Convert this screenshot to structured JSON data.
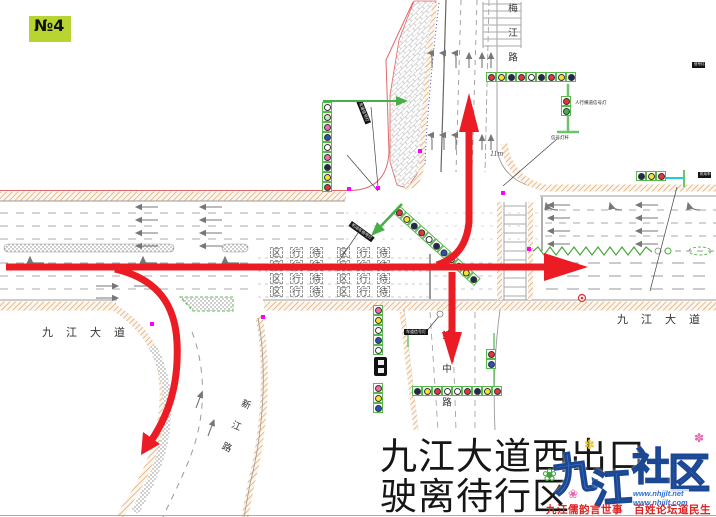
{
  "badge": {
    "label": "№4",
    "bg": "#b7d433"
  },
  "title": {
    "line1": "九江大道西出口",
    "line2": "驶离待行区"
  },
  "road_labels": {
    "west": "九江大道",
    "east": "九江大道",
    "north": "梅江路",
    "south": "建中路",
    "southwest": "新江路"
  },
  "lane_marking": {
    "waiting_cells": [
      "区",
      "行",
      "待"
    ],
    "meaning": "待行区",
    "rows": 4,
    "groups": 2
  },
  "notes": {
    "distance": "11m"
  },
  "tags": {
    "pedestrian_signal": "人行横道信号灯",
    "signal_pole": "信号灯杆",
    "lane_signal": "车道信号灯",
    "vehicle_signal": "机动车信号灯"
  },
  "flow_arrows": {
    "color": "#ec1c24",
    "movements": [
      "through-east",
      "exit-north",
      "exit-south",
      "exit-southwest"
    ]
  },
  "signals": {
    "palette": {
      "red": "#e8333a",
      "pink": "#ef6fa8",
      "yellow": "#f5e42c",
      "dark": "#1d2c4e",
      "blue": "#2a52b0",
      "white": "#ffffff",
      "green": "#3cb54a",
      "lightgreen": "#cdeaa8"
    },
    "clusters": [
      {
        "id": "north-approach-bar",
        "x": 486,
        "y": 72,
        "dir": "h",
        "lamps": [
          "red",
          "yellow",
          "dark",
          "red",
          "white",
          "dark",
          "red",
          "yellow",
          "dark"
        ]
      },
      {
        "id": "west-pole-stack",
        "x": 322,
        "y": 102,
        "dir": "v",
        "lamps": [
          "white",
          "lightgreen",
          "pink",
          "blue",
          "white",
          "pink",
          "dark",
          "yellow",
          "red"
        ]
      },
      {
        "id": "northwest-diagonal-bar",
        "x": 399,
        "y": 205,
        "dir": "h",
        "rotate": 42,
        "lamps": [
          "red",
          "yellow",
          "dark",
          "red",
          "white",
          "dark",
          "blue",
          "white",
          "red",
          "yellow",
          "dark"
        ]
      },
      {
        "id": "south-approach-bar",
        "x": 412,
        "y": 386,
        "dir": "h",
        "lamps": [
          "dark",
          "yellow",
          "red",
          "white",
          "white",
          "red",
          "dark",
          "yellow",
          "red"
        ]
      },
      {
        "id": "southwest-pole-upper",
        "x": 373,
        "y": 305,
        "dir": "v",
        "lamps": [
          "pink",
          "yellow",
          "white",
          "blue",
          "white"
        ]
      },
      {
        "id": "southwest-pole-lower",
        "x": 373,
        "y": 383,
        "dir": "v",
        "lamps": [
          "pink",
          "yellow",
          "blue"
        ]
      },
      {
        "id": "pedestrian-signal",
        "x": 561,
        "y": 96,
        "dir": "v",
        "lamps": [
          "red",
          "green"
        ]
      },
      {
        "id": "median-pair",
        "x": 486,
        "y": 349,
        "dir": "v",
        "lamps": [
          "red",
          "blue"
        ]
      },
      {
        "id": "east-arm-signal",
        "x": 636,
        "y": 171,
        "dir": "h",
        "lamps": [
          "dark",
          "yellow",
          "red"
        ]
      }
    ]
  },
  "watermark": {
    "site_chars": [
      "九",
      "江",
      "社",
      "区"
    ],
    "url1": "www.nhjjlt.net",
    "url2": "www.nhjjlt.com",
    "slogan": "九江儒韵言世事　百姓论坛道民生",
    "icons": {
      "clover": "❀",
      "petal": "✽"
    },
    "colors": {
      "text": "#4a86dd",
      "outline": "#1b4793",
      "slogan": "#dd2222"
    }
  }
}
